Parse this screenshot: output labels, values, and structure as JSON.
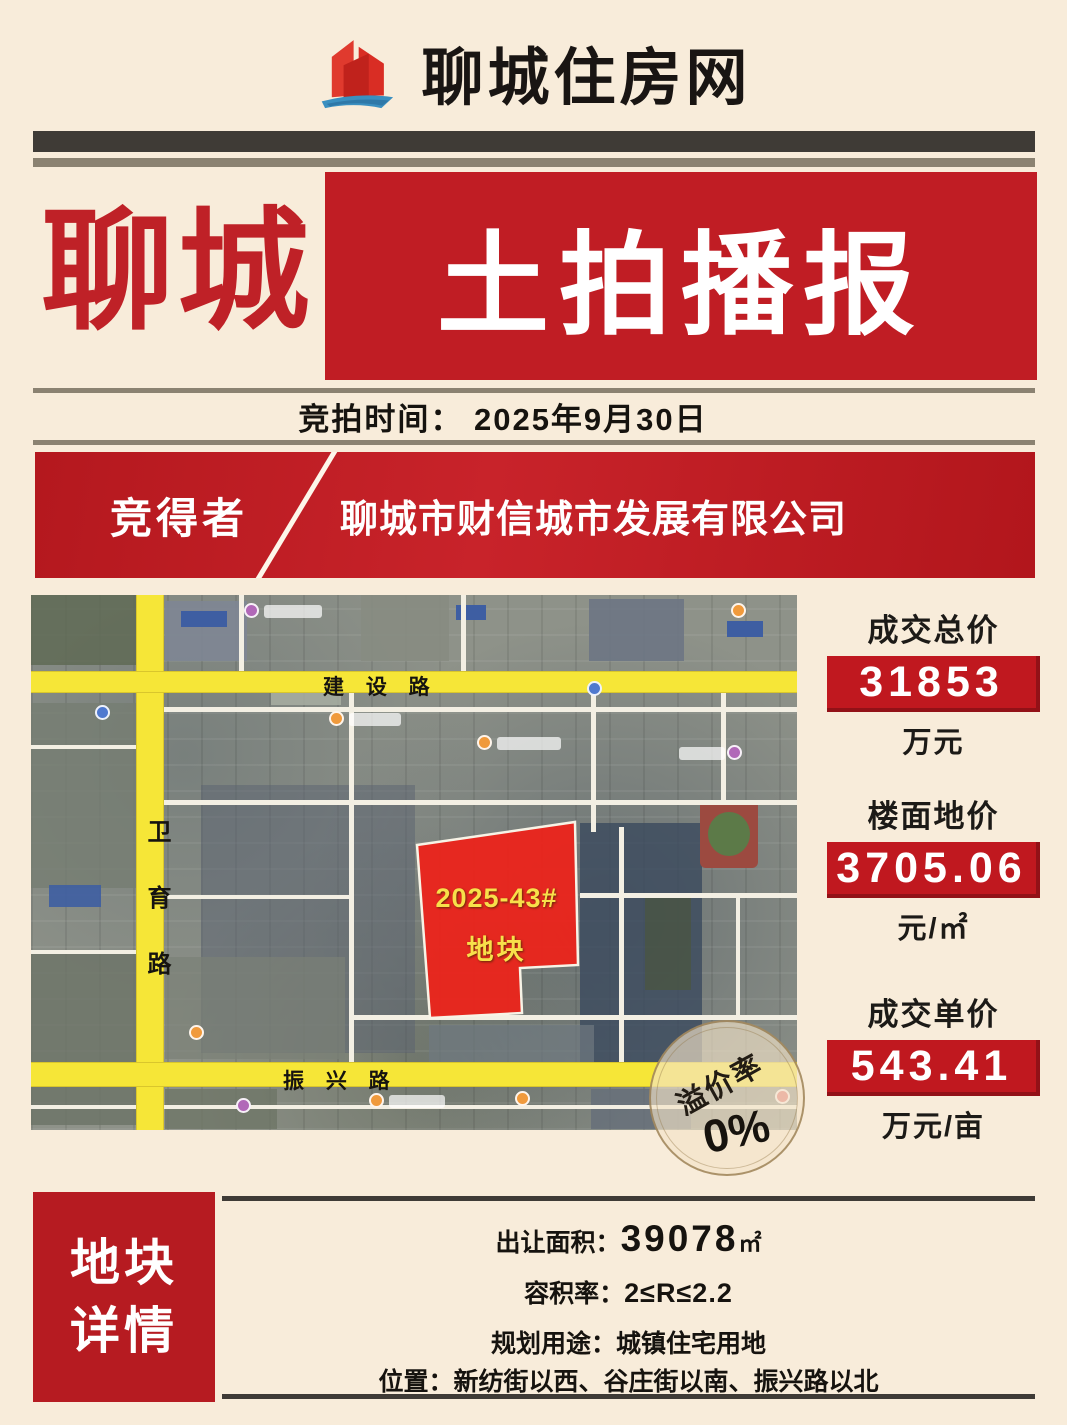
{
  "colors": {
    "background": "#f8ecda",
    "accent_red": "#c01d24",
    "dark_bar": "#3f3b36",
    "olive_bar": "#8b8271",
    "road_yellow": "#f6e637",
    "plot_red": "#ea241c",
    "plot_label_yellow": "#f8e04a"
  },
  "header": {
    "site_name": "聊城住房网",
    "logo_icon": "buildings-sail-logo"
  },
  "banner": {
    "city": "聊城",
    "title": "土拍播报"
  },
  "auction": {
    "time_label": "竞拍时间：",
    "time_value": "2025年9月30日"
  },
  "winner": {
    "label": "竞得者",
    "company": "聊城市财信城市发展有限公司"
  },
  "map": {
    "road_top": "建 设 路",
    "road_left": "卫育路",
    "road_bottom": "振 兴 路",
    "plot_code": "2025-43#",
    "plot_label": "地块",
    "stamp_label": "溢价率",
    "stamp_value": "0%"
  },
  "stats": [
    {
      "label": "成交总价",
      "value": "31853",
      "unit": "万元"
    },
    {
      "label": "楼面地价",
      "value": "3705.06",
      "unit": "元/㎡"
    },
    {
      "label": "成交单价",
      "value": "543.41",
      "unit": "万元/亩"
    }
  ],
  "details": {
    "block_line1": "地块",
    "block_line2": "详情",
    "rows": [
      {
        "label": "出让面积：",
        "value": "39078",
        "suffix": "㎡"
      },
      {
        "label": "容积率：",
        "value": "2≤R≤2.2",
        "suffix": ""
      },
      {
        "label": "规划用途：",
        "value": "城镇住宅用地",
        "suffix": ""
      },
      {
        "label": "位置：",
        "value": "新纺街以西、谷庄街以南、振兴路以北",
        "suffix": ""
      }
    ]
  }
}
